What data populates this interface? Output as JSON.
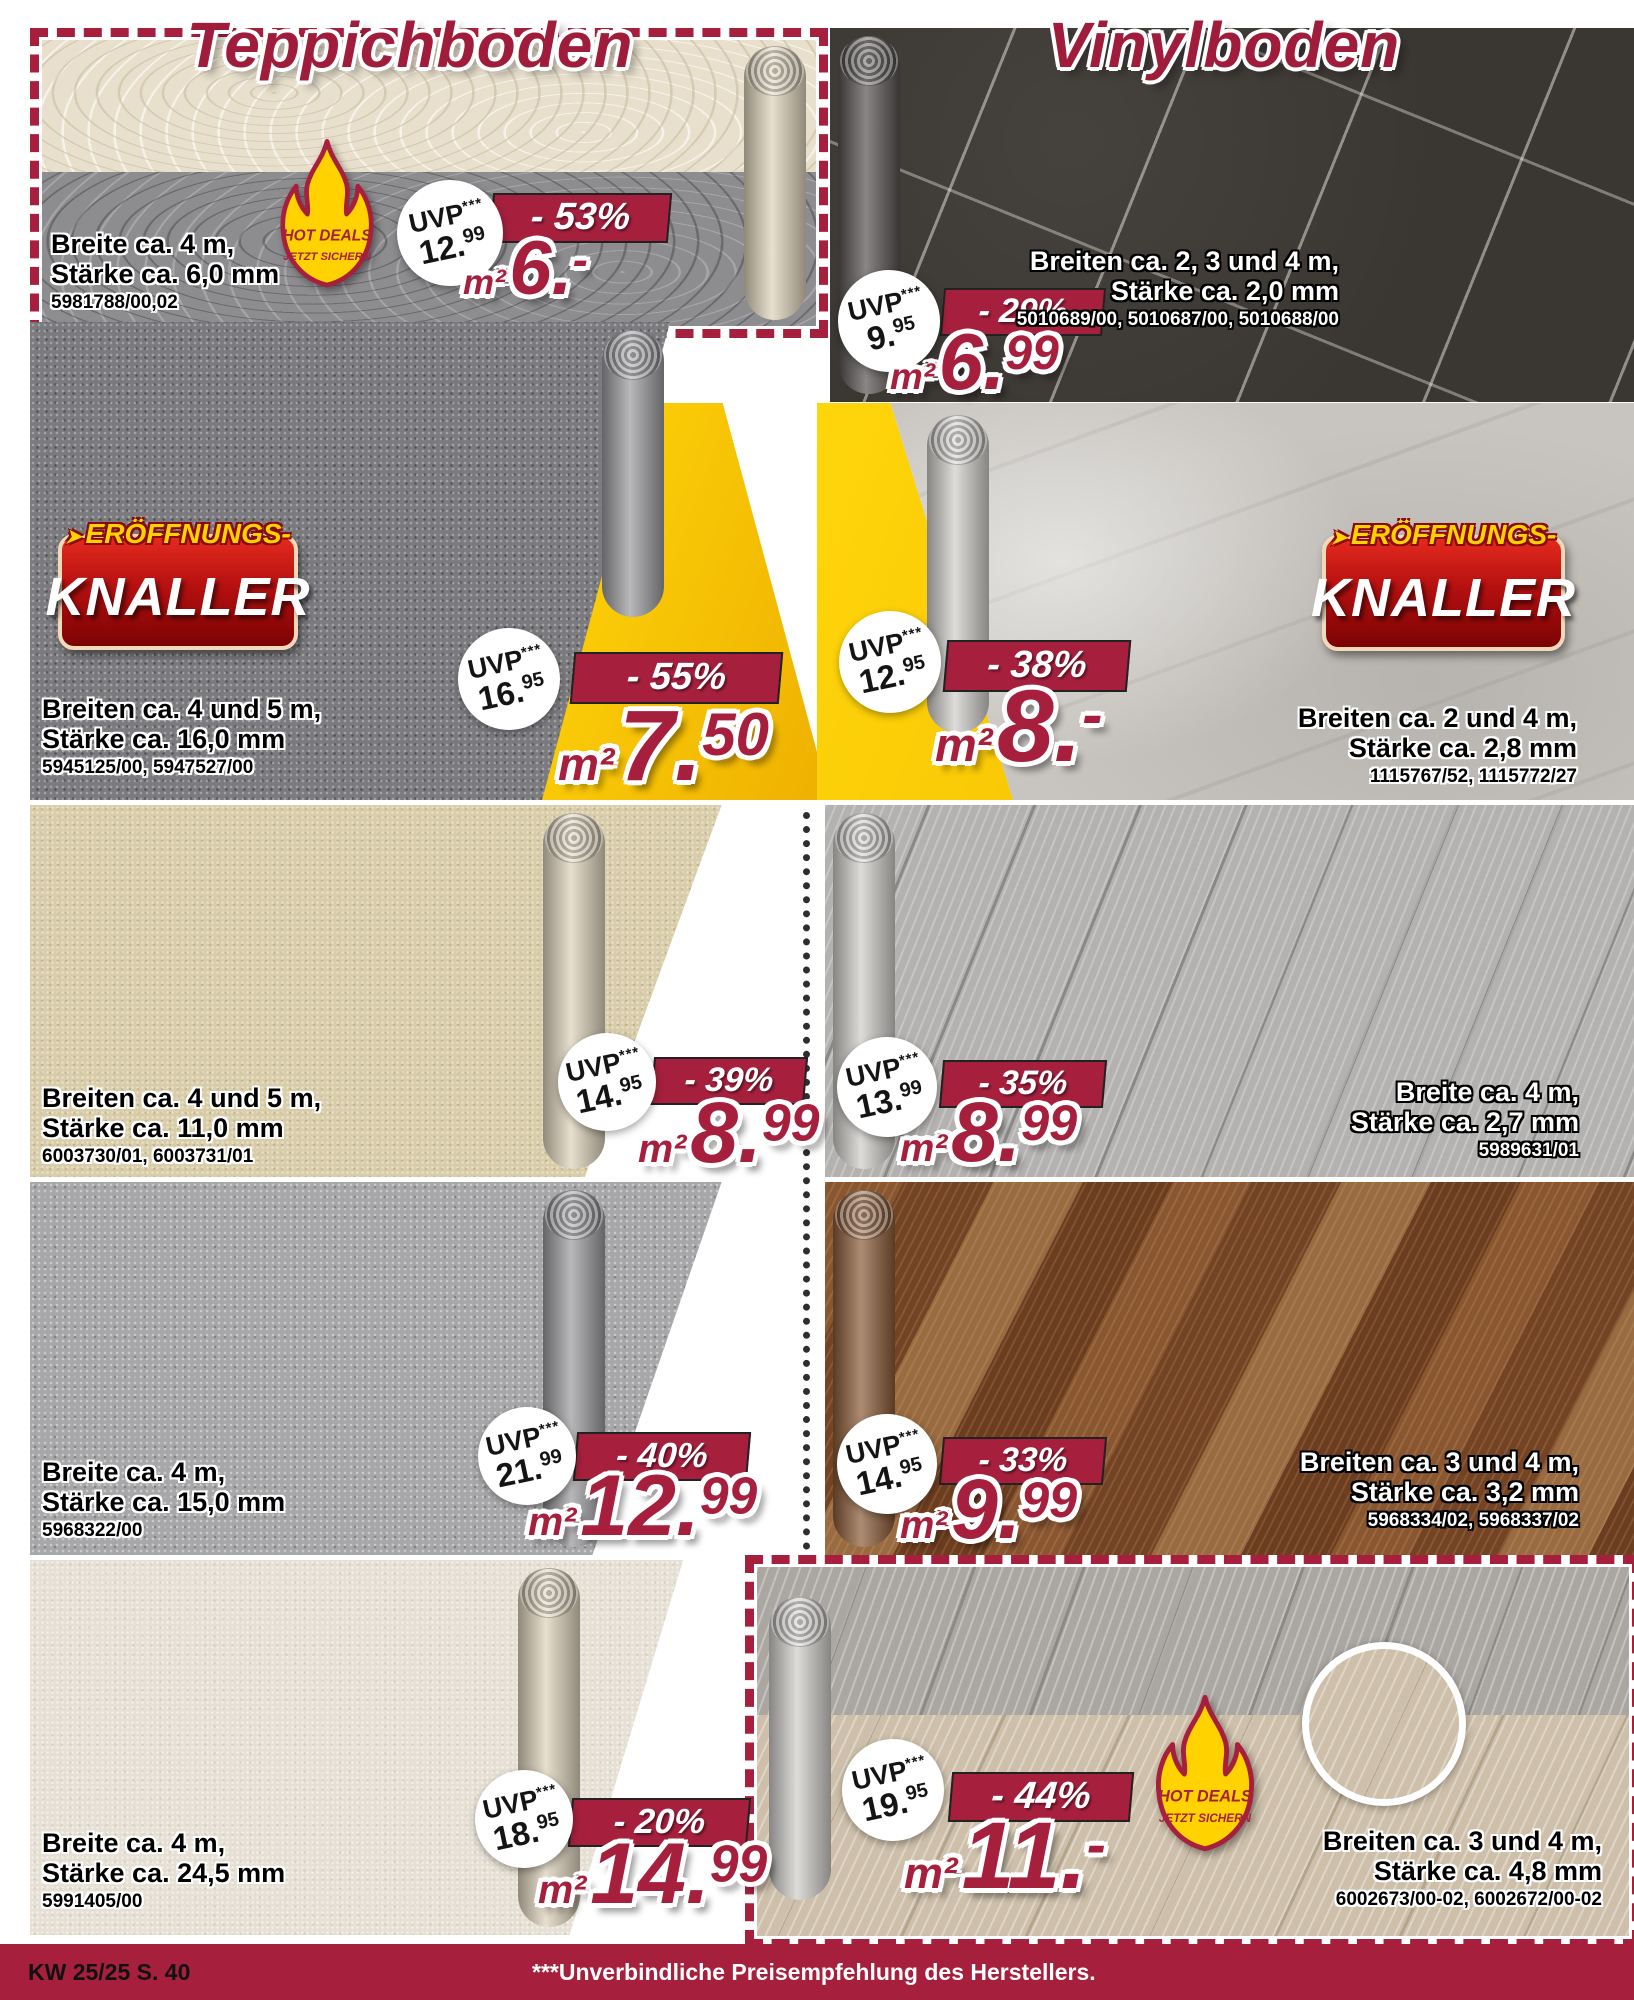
{
  "titles": {
    "left": "Teppichboden",
    "right": "Vinylboden"
  },
  "labels": {
    "uvp": "UVP",
    "uvp_stars": "***",
    "unit": "m²"
  },
  "badges": {
    "hot_deals_line1": "HOT DEALS",
    "hot_deals_line2": "JETZT SICHERN",
    "knaller_arrow": "➤",
    "knaller_top": "ERÖFFNUNGS-",
    "knaller_main": "KNALLER"
  },
  "footer": {
    "page_ref": "KW 25/25 S. 40",
    "price_note": "***Unverbindliche Preisempfehlung des Herstellers."
  },
  "colors": {
    "accent": "#a6203e",
    "deal_yellow": "#ffd60a",
    "flame_yellow": "#ffd200"
  },
  "products": [
    {
      "uvp_main": "12.",
      "uvp_sup": "99",
      "discount": "- 53%",
      "price_main": "6.",
      "price_sup": "-",
      "detail1": "Breite ca. 4 m,",
      "detail2": "Stärke ca. 6,0 mm",
      "articles": "5981788/00,02"
    },
    {
      "uvp_main": "16.",
      "uvp_sup": "95",
      "discount": "- 55%",
      "price_main": "7.",
      "price_sup": "50",
      "detail1": "Breiten ca. 4 und 5 m,",
      "detail2": "Stärke ca. 16,0 mm",
      "articles": "5945125/00, 5947527/00"
    },
    {
      "uvp_main": "14.",
      "uvp_sup": "95",
      "discount": "- 39%",
      "price_main": "8.",
      "price_sup": "99",
      "detail1": "Breiten ca. 4 und 5 m,",
      "detail2": "Stärke ca. 11,0 mm",
      "articles": "6003730/01, 6003731/01"
    },
    {
      "uvp_main": "21.",
      "uvp_sup": "99",
      "discount": "- 40%",
      "price_main": "12.",
      "price_sup": "99",
      "detail1": "Breite ca. 4 m,",
      "detail2": "Stärke ca. 15,0 mm",
      "articles": "5968322/00"
    },
    {
      "uvp_main": "18.",
      "uvp_sup": "95",
      "discount": "- 20%",
      "price_main": "14.",
      "price_sup": "99",
      "detail1": "Breite ca. 4 m,",
      "detail2": "Stärke ca. 24,5 mm",
      "articles": "5991405/00"
    },
    {
      "uvp_main": "9.",
      "uvp_sup": "95",
      "discount": "- 29%",
      "price_main": "6.",
      "price_sup": "99",
      "detail1": "Breiten ca. 2, 3 und 4 m,",
      "detail2": "Stärke ca. 2,0 mm",
      "articles": "5010689/00, 5010687/00, 5010688/00"
    },
    {
      "uvp_main": "12.",
      "uvp_sup": "95",
      "discount": "- 38%",
      "price_main": "8.",
      "price_sup": "-",
      "detail1": "Breiten ca. 2 und 4 m,",
      "detail2": "Stärke ca. 2,8 mm",
      "articles": "1115767/52, 1115772/27"
    },
    {
      "uvp_main": "13.",
      "uvp_sup": "99",
      "discount": "- 35%",
      "price_main": "8.",
      "price_sup": "99",
      "detail1": "Breite ca. 4 m,",
      "detail2": "Stärke ca. 2,7 mm",
      "articles": "5989631/01"
    },
    {
      "uvp_main": "14.",
      "uvp_sup": "95",
      "discount": "- 33%",
      "price_main": "9.",
      "price_sup": "99",
      "detail1": "Breiten ca. 3 und 4 m,",
      "detail2": "Stärke ca. 3,2 mm",
      "articles": "5968334/02, 5968337/02"
    },
    {
      "uvp_main": "19.",
      "uvp_sup": "95",
      "discount": "- 44%",
      "price_main": "11.",
      "price_sup": "-",
      "detail1": "Breiten ca. 3 und 4 m,",
      "detail2": "Stärke ca. 4,8 mm",
      "articles": "6002673/00-02, 6002672/00-02"
    }
  ]
}
